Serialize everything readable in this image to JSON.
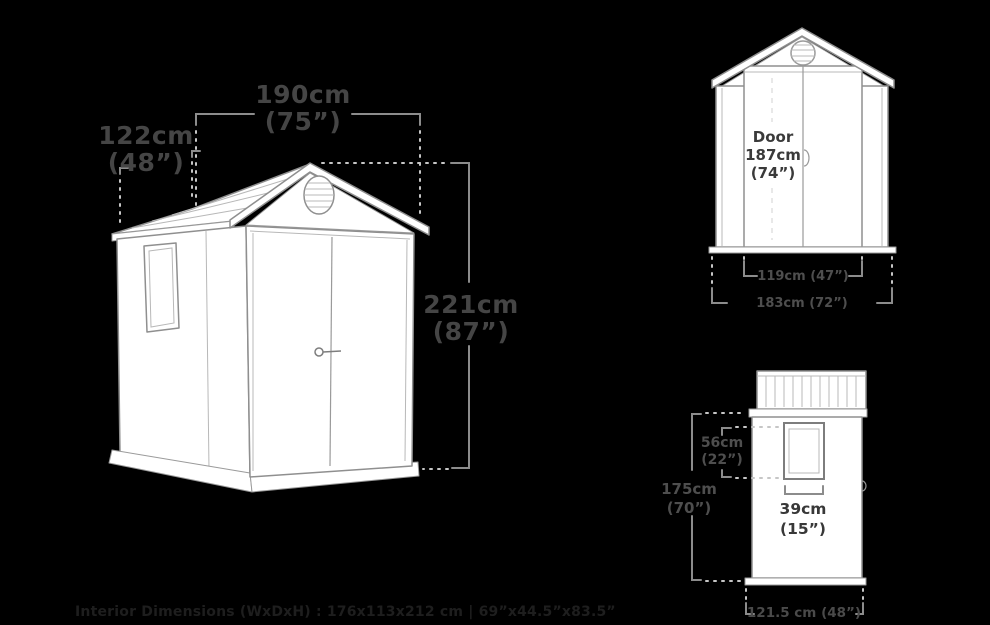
{
  "main_view": {
    "width_cm": "190cm",
    "width_in": "(75”)",
    "depth_cm": "122cm",
    "depth_in": "(48”)",
    "height_cm": "221cm",
    "height_in": "(87”)"
  },
  "front_view": {
    "door_label": "Door",
    "door_height_cm": "187cm",
    "door_height_in": "(74”)",
    "door_width": "119cm (47”)",
    "overall_width": "183cm (72”)"
  },
  "side_view": {
    "window_height_cm": "56cm",
    "window_height_in": "(22”)",
    "height_cm": "175cm",
    "height_in": "(70”)",
    "window_width_cm": "39cm",
    "window_width_in": "(15”)",
    "depth": "121.5 cm (48”)"
  },
  "footer": {
    "interior_dimensions": "Interior Dimensions (WxDxH) : 176x113x212 cm | 69”x44.5”x83.5”"
  },
  "colors": {
    "background": "#000000",
    "shed_fill": "#ffffff",
    "outline": "#8f8f8f",
    "dimension_line": "#8c8c8c",
    "dotted_line": "#c6c6c6",
    "label_text": "#454545",
    "label_text_on_white": "#3a3a3a",
    "footer_text": "#1e1e1e"
  }
}
